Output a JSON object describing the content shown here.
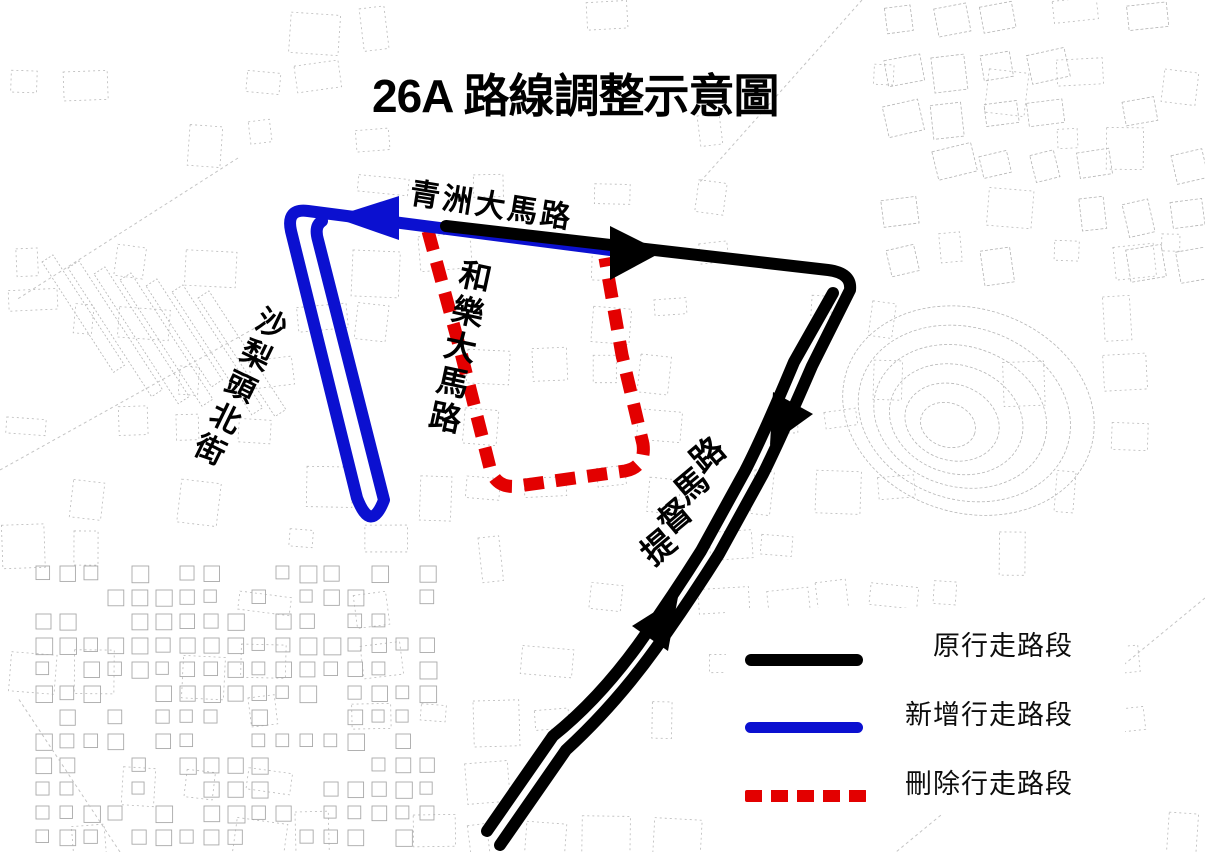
{
  "title": "26A 路線調整示意圖",
  "map": {
    "street_labels": [
      {
        "id": "qingzhou",
        "text": "青洲大馬路"
      },
      {
        "id": "holok",
        "text": "和樂大馬路"
      },
      {
        "id": "salitou",
        "text": "沙梨頭北街"
      },
      {
        "id": "almirante",
        "text": "提督馬路"
      }
    ],
    "routes": [
      {
        "name": "original-route",
        "meaning": "原行走路段",
        "style": "solid",
        "color": "#000000"
      },
      {
        "name": "new-route",
        "meaning": "新增行走路段",
        "style": "solid",
        "color": "#0b10d0"
      },
      {
        "name": "removed-route",
        "meaning": "刪除行走路段",
        "style": "dashed",
        "color": "#e30000"
      }
    ]
  },
  "legend": {
    "items": [
      {
        "label": "原行走路段",
        "line_style": "solid",
        "color": "#000000"
      },
      {
        "label": "新增行走路段",
        "line_style": "solid",
        "color": "#0b10d0"
      },
      {
        "label": "刪除行走路段",
        "line_style": "dashed",
        "color": "#e30000"
      }
    ]
  },
  "colors": {
    "route_original": "#000000",
    "route_new": "#0b10d0",
    "route_removed": "#e30000",
    "map_lines": "#b9b9b9",
    "background": "#ffffff",
    "text": "#000000"
  }
}
